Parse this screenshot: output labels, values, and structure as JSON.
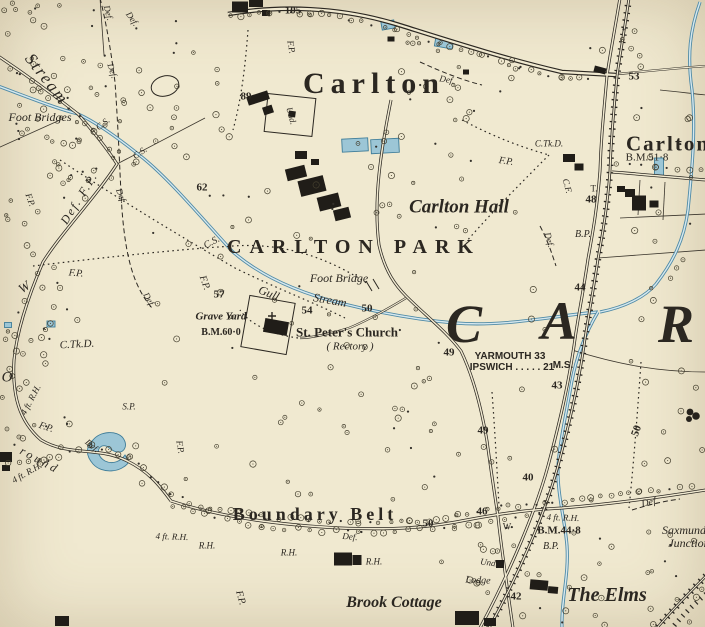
{
  "map": {
    "description": "Historic Ordnance Survey style map extract of Carlton / Carlton Park",
    "paper": "#f0e9d0",
    "ink": "#2b2721",
    "water": {
      "fill": "#9cc6d6",
      "line": "#4f8aa6",
      "light": "#d6e8ee"
    },
    "labels": [
      {
        "id": "carlton-village",
        "t": "Carlton",
        "x": 374,
        "y": 84,
        "s": 30,
        "f": "r",
        "ls": 6,
        "w": 600
      },
      {
        "id": "carlton-hamlet",
        "t": "Carlton",
        "x": 668,
        "y": 144,
        "s": 21,
        "f": "r",
        "ls": 2,
        "w": 600
      },
      {
        "id": "carlton-hall",
        "t": "Carlton Hall",
        "x": 459,
        "y": 207,
        "s": 19,
        "f": "i",
        "w": 600
      },
      {
        "id": "carlton-park",
        "t": "CARLTON PARK",
        "x": 354,
        "y": 247,
        "s": 20,
        "f": "r",
        "ls": 8,
        "w": 600
      },
      {
        "id": "big-letter-c",
        "t": "C",
        "x": 464,
        "y": 324,
        "s": 54,
        "f": "i",
        "w": 600
      },
      {
        "id": "big-letter-a",
        "t": "A",
        "x": 559,
        "y": 321,
        "s": 54,
        "f": "i",
        "w": 600
      },
      {
        "id": "big-letter-r",
        "t": "R",
        "x": 676,
        "y": 324,
        "s": 54,
        "f": "i",
        "w": 600
      },
      {
        "id": "the-elms",
        "t": "The Elms",
        "x": 607,
        "y": 595,
        "s": 20,
        "f": "i",
        "w": 600
      },
      {
        "id": "brook-cottage",
        "t": "Brook Cottage",
        "x": 394,
        "y": 603,
        "s": 16,
        "f": "i",
        "w": 600
      },
      {
        "id": "boundary-belt",
        "t": "Boundary Belt",
        "x": 315,
        "y": 514,
        "s": 18,
        "f": "r",
        "ls": 4,
        "w": 600
      },
      {
        "id": "stream-nw",
        "t": "Stream",
        "x": 47,
        "y": 79,
        "s": 17,
        "f": "i",
        "r": 52,
        "ls": 2,
        "w": 500
      },
      {
        "id": "st-peters-church",
        "t": "St. Peter's Church",
        "x": 347,
        "y": 332,
        "s": 13,
        "f": "r",
        "w": 600
      },
      {
        "id": "rectory",
        "t": "( Rectory )",
        "x": 350,
        "y": 347,
        "s": 11,
        "f": "i"
      },
      {
        "id": "grave-yard",
        "t": "Grave Yard",
        "x": 221,
        "y": 317,
        "s": 11,
        "f": "i",
        "w": 600
      },
      {
        "id": "bm-60-0",
        "t": "B.M.60·0",
        "x": 221,
        "y": 333,
        "s": 10,
        "f": "r",
        "w": 600
      },
      {
        "id": "foot-bridge",
        "t": "Foot Bridge",
        "x": 339,
        "y": 278,
        "s": 12,
        "f": "i",
        "w": 500
      },
      {
        "id": "gull",
        "t": "Gull",
        "x": 269,
        "y": 293,
        "s": 12,
        "f": "i",
        "r": 22,
        "w": 500
      },
      {
        "id": "gull-stream",
        "t": "Stream",
        "x": 330,
        "y": 300,
        "s": 12,
        "f": "i",
        "r": 10,
        "w": 500
      },
      {
        "id": "foot-bridges",
        "t": "Foot Bridges",
        "x": 40,
        "y": 117,
        "s": 12,
        "f": "i",
        "w": 500
      },
      {
        "id": "yarmouth-miles",
        "t": "YARMOUTH 33",
        "x": 510,
        "y": 357,
        "s": 10,
        "f": "s",
        "w": 600
      },
      {
        "id": "ipswich-miles",
        "t": "IPSWICH . . . . . 21",
        "x": 512,
        "y": 368,
        "s": 10,
        "f": "s",
        "w": 600
      },
      {
        "id": "milestone-ms",
        "t": "M.S.",
        "x": 563,
        "y": 366,
        "s": 10,
        "f": "s",
        "w": 600
      },
      {
        "id": "saxmundham",
        "t": "Saxmund",
        "x": 684,
        "y": 530,
        "s": 12,
        "f": "i",
        "w": 500
      },
      {
        "id": "junction",
        "t": "Junction",
        "x": 689,
        "y": 543,
        "s": 12,
        "f": "i",
        "w": 500
      },
      {
        "id": "cs-1",
        "t": "C.S.",
        "x": 103,
        "y": 124,
        "s": 9,
        "f": "i",
        "r": -38
      },
      {
        "id": "cs-2",
        "t": "C.S.",
        "x": 140,
        "y": 153,
        "s": 9,
        "f": "i",
        "r": -35
      },
      {
        "id": "cs-3",
        "t": "C.S.",
        "x": 212,
        "y": 243,
        "s": 10,
        "f": "i",
        "r": -28
      },
      {
        "id": "def-1",
        "t": "Def.",
        "x": 108,
        "y": 13,
        "s": 9,
        "f": "i",
        "r": 75
      },
      {
        "id": "def-2",
        "t": "Def.",
        "x": 132,
        "y": 19,
        "s": 9,
        "f": "i",
        "r": 55
      },
      {
        "id": "def-3",
        "t": "Def.",
        "x": 112,
        "y": 71,
        "s": 9,
        "f": "i",
        "r": 72
      },
      {
        "id": "def-4",
        "t": "Def.",
        "x": 121,
        "y": 196,
        "s": 9,
        "f": "i",
        "r": 68
      },
      {
        "id": "def-5",
        "t": "Def.",
        "x": 149,
        "y": 300,
        "s": 9,
        "f": "i",
        "r": 60
      },
      {
        "id": "def-6",
        "t": "Def.",
        "x": 447,
        "y": 80,
        "s": 9,
        "f": "i",
        "r": 10
      },
      {
        "id": "def-7",
        "t": "Def.",
        "x": 549,
        "y": 240,
        "s": 9,
        "f": "i",
        "r": 75
      },
      {
        "id": "def-8",
        "t": "Def.",
        "x": 92,
        "y": 446,
        "s": 9,
        "f": "i",
        "r": 40
      },
      {
        "id": "def-9",
        "t": "Def.",
        "x": 350,
        "y": 537,
        "s": 9,
        "f": "i",
        "r": 5
      },
      {
        "id": "def-10",
        "t": "Def.",
        "x": 650,
        "y": 503,
        "s": 10,
        "f": "i",
        "r": -12
      },
      {
        "id": "def-fp",
        "t": "Def. F.P.",
        "x": 79,
        "y": 198,
        "s": 12,
        "f": "i",
        "r": -58,
        "ls": 2,
        "w": 500
      },
      {
        "id": "fp-1",
        "t": "F.P.",
        "x": 291,
        "y": 47,
        "s": 9,
        "f": "i",
        "r": 80
      },
      {
        "id": "fp-2",
        "t": "F.P.",
        "x": 30,
        "y": 200,
        "s": 9,
        "f": "i",
        "r": 70
      },
      {
        "id": "fp-3",
        "t": "F.P.",
        "x": 76,
        "y": 274,
        "s": 10,
        "f": "i",
        "r": 5
      },
      {
        "id": "fp-4",
        "t": "F.P.",
        "x": 204,
        "y": 283,
        "s": 10,
        "f": "i",
        "r": 70
      },
      {
        "id": "fp-5",
        "t": "F.P.",
        "x": 506,
        "y": 162,
        "s": 10,
        "f": "i",
        "r": 8
      },
      {
        "id": "fp-6",
        "t": "F.P.",
        "x": 180,
        "y": 447,
        "s": 9,
        "f": "i",
        "r": 80
      },
      {
        "id": "fp-7",
        "t": "F.P.",
        "x": 46,
        "y": 428,
        "s": 10,
        "f": "i",
        "r": 18
      },
      {
        "id": "fp-8",
        "t": "F.P.",
        "x": 240,
        "y": 598,
        "s": 10,
        "f": "i",
        "r": 75
      },
      {
        "id": "rh-1",
        "t": "4 ft. R.H.",
        "x": 31,
        "y": 400,
        "s": 9,
        "f": "i",
        "r": -62
      },
      {
        "id": "rh-2",
        "t": "4 ft. R.H.",
        "x": 27,
        "y": 473,
        "s": 9,
        "f": "i",
        "r": -30
      },
      {
        "id": "rh-3",
        "t": "4 ft. R.H.",
        "x": 172,
        "y": 537,
        "s": 9,
        "f": "i",
        "r": 2
      },
      {
        "id": "rh-4",
        "t": "4 ft. R.H.",
        "x": 563,
        "y": 518,
        "s": 9,
        "f": "i",
        "r": 2
      },
      {
        "id": "rh-5",
        "t": "R.H.",
        "x": 207,
        "y": 546,
        "s": 9,
        "f": "i"
      },
      {
        "id": "rh-6",
        "t": "R.H.",
        "x": 289,
        "y": 553,
        "s": 9,
        "f": "i"
      },
      {
        "id": "rh-7",
        "t": "R.H.",
        "x": 374,
        "y": 562,
        "s": 9,
        "f": "i"
      },
      {
        "id": "ctkd-1",
        "t": "C.Tk.D.",
        "x": 77,
        "y": 345,
        "s": 11,
        "f": "i",
        "r": -3
      },
      {
        "id": "ctkd-2",
        "t": "C.Tk.D.",
        "x": 549,
        "y": 144,
        "s": 9,
        "f": "i"
      },
      {
        "id": "cf",
        "t": "C.F.",
        "x": 567,
        "y": 186,
        "s": 9,
        "f": "i",
        "r": 75
      },
      {
        "id": "t-mark",
        "t": "T.",
        "x": 594,
        "y": 189,
        "s": 9,
        "f": "r"
      },
      {
        "id": "bp-1",
        "t": "B.P.",
        "x": 583,
        "y": 235,
        "s": 10,
        "f": "i"
      },
      {
        "id": "bp-2",
        "t": "B.P.",
        "x": 551,
        "y": 547,
        "s": 10,
        "f": "i"
      },
      {
        "id": "bm-51-8",
        "t": "B.M.51·8",
        "x": 647,
        "y": 158,
        "s": 11,
        "f": "r",
        "w": 500
      },
      {
        "id": "bm-44-8",
        "t": "B.M.44·8",
        "x": 559,
        "y": 531,
        "s": 11,
        "f": "r",
        "w": 600
      },
      {
        "id": "w-gate",
        "t": "W",
        "x": 507,
        "y": 527,
        "s": 9,
        "f": "r"
      },
      {
        "id": "w-big",
        "t": "W",
        "x": 24,
        "y": 287,
        "s": 13,
        "f": "i",
        "r": -35
      },
      {
        "id": "o-big",
        "t": "O",
        "x": 7,
        "y": 378,
        "s": 15,
        "f": "i"
      },
      {
        "id": "round",
        "t": "round",
        "x": 40,
        "y": 460,
        "s": 12,
        "f": "i",
        "r": 28,
        "ls": 3
      },
      {
        "id": "sp",
        "t": "S.P.",
        "x": 129,
        "y": 407,
        "s": 9,
        "f": "i"
      },
      {
        "id": "und-1",
        "t": "Und.",
        "x": 291,
        "y": 116,
        "s": 9,
        "f": "i",
        "r": 75
      },
      {
        "id": "und-2",
        "t": "Und.",
        "x": 489,
        "y": 563,
        "s": 9,
        "f": "i",
        "r": 8
      },
      {
        "id": "lodge",
        "t": "Lodge",
        "x": 478,
        "y": 581,
        "s": 10,
        "f": "i",
        "r": 3
      },
      {
        "id": "n-105",
        "t": "105",
        "x": 293,
        "y": 11,
        "s": 11,
        "f": "r",
        "w": 600
      },
      {
        "id": "n-89",
        "t": "89",
        "x": 246,
        "y": 97,
        "s": 11,
        "f": "r",
        "w": 600
      },
      {
        "id": "n-62",
        "t": "62",
        "x": 202,
        "y": 188,
        "s": 11,
        "f": "r",
        "w": 600
      },
      {
        "id": "n-57",
        "t": "57",
        "x": 219,
        "y": 295,
        "s": 11,
        "f": "r",
        "w": 600
      },
      {
        "id": "n-54",
        "t": "54",
        "x": 307,
        "y": 311,
        "s": 11,
        "f": "r",
        "w": 600
      },
      {
        "id": "n-50-stream",
        "t": "50",
        "x": 367,
        "y": 309,
        "s": 11,
        "f": "r",
        "w": 600
      },
      {
        "id": "n-53",
        "t": "53",
        "x": 634,
        "y": 77,
        "s": 11,
        "f": "r",
        "w": 600
      },
      {
        "id": "n-48",
        "t": "48",
        "x": 591,
        "y": 200,
        "s": 11,
        "f": "r",
        "w": 600
      },
      {
        "id": "n-44",
        "t": "44",
        "x": 580,
        "y": 288,
        "s": 11,
        "f": "r",
        "w": 600
      },
      {
        "id": "n-43",
        "t": "43",
        "x": 557,
        "y": 386,
        "s": 11,
        "f": "r",
        "w": 600
      },
      {
        "id": "n-49-a",
        "t": "49",
        "x": 449,
        "y": 353,
        "s": 11,
        "f": "r",
        "w": 600
      },
      {
        "id": "n-49-b",
        "t": "49",
        "x": 483,
        "y": 431,
        "s": 11,
        "f": "r",
        "w": 600
      },
      {
        "id": "n-50-rot",
        "t": "50",
        "x": 637,
        "y": 431,
        "s": 11,
        "f": "r",
        "r": -70,
        "w": 600
      },
      {
        "id": "n-46",
        "t": "46",
        "x": 482,
        "y": 512,
        "s": 11,
        "f": "r",
        "w": 600
      },
      {
        "id": "n-40",
        "t": "40",
        "x": 528,
        "y": 478,
        "s": 11,
        "f": "r",
        "w": 600
      },
      {
        "id": "n-42",
        "t": "42",
        "x": 516,
        "y": 597,
        "s": 11,
        "f": "r",
        "w": 600
      },
      {
        "id": "n-50-belt",
        "t": "50",
        "x": 428,
        "y": 524,
        "s": 11,
        "f": "r",
        "w": 600
      }
    ]
  }
}
